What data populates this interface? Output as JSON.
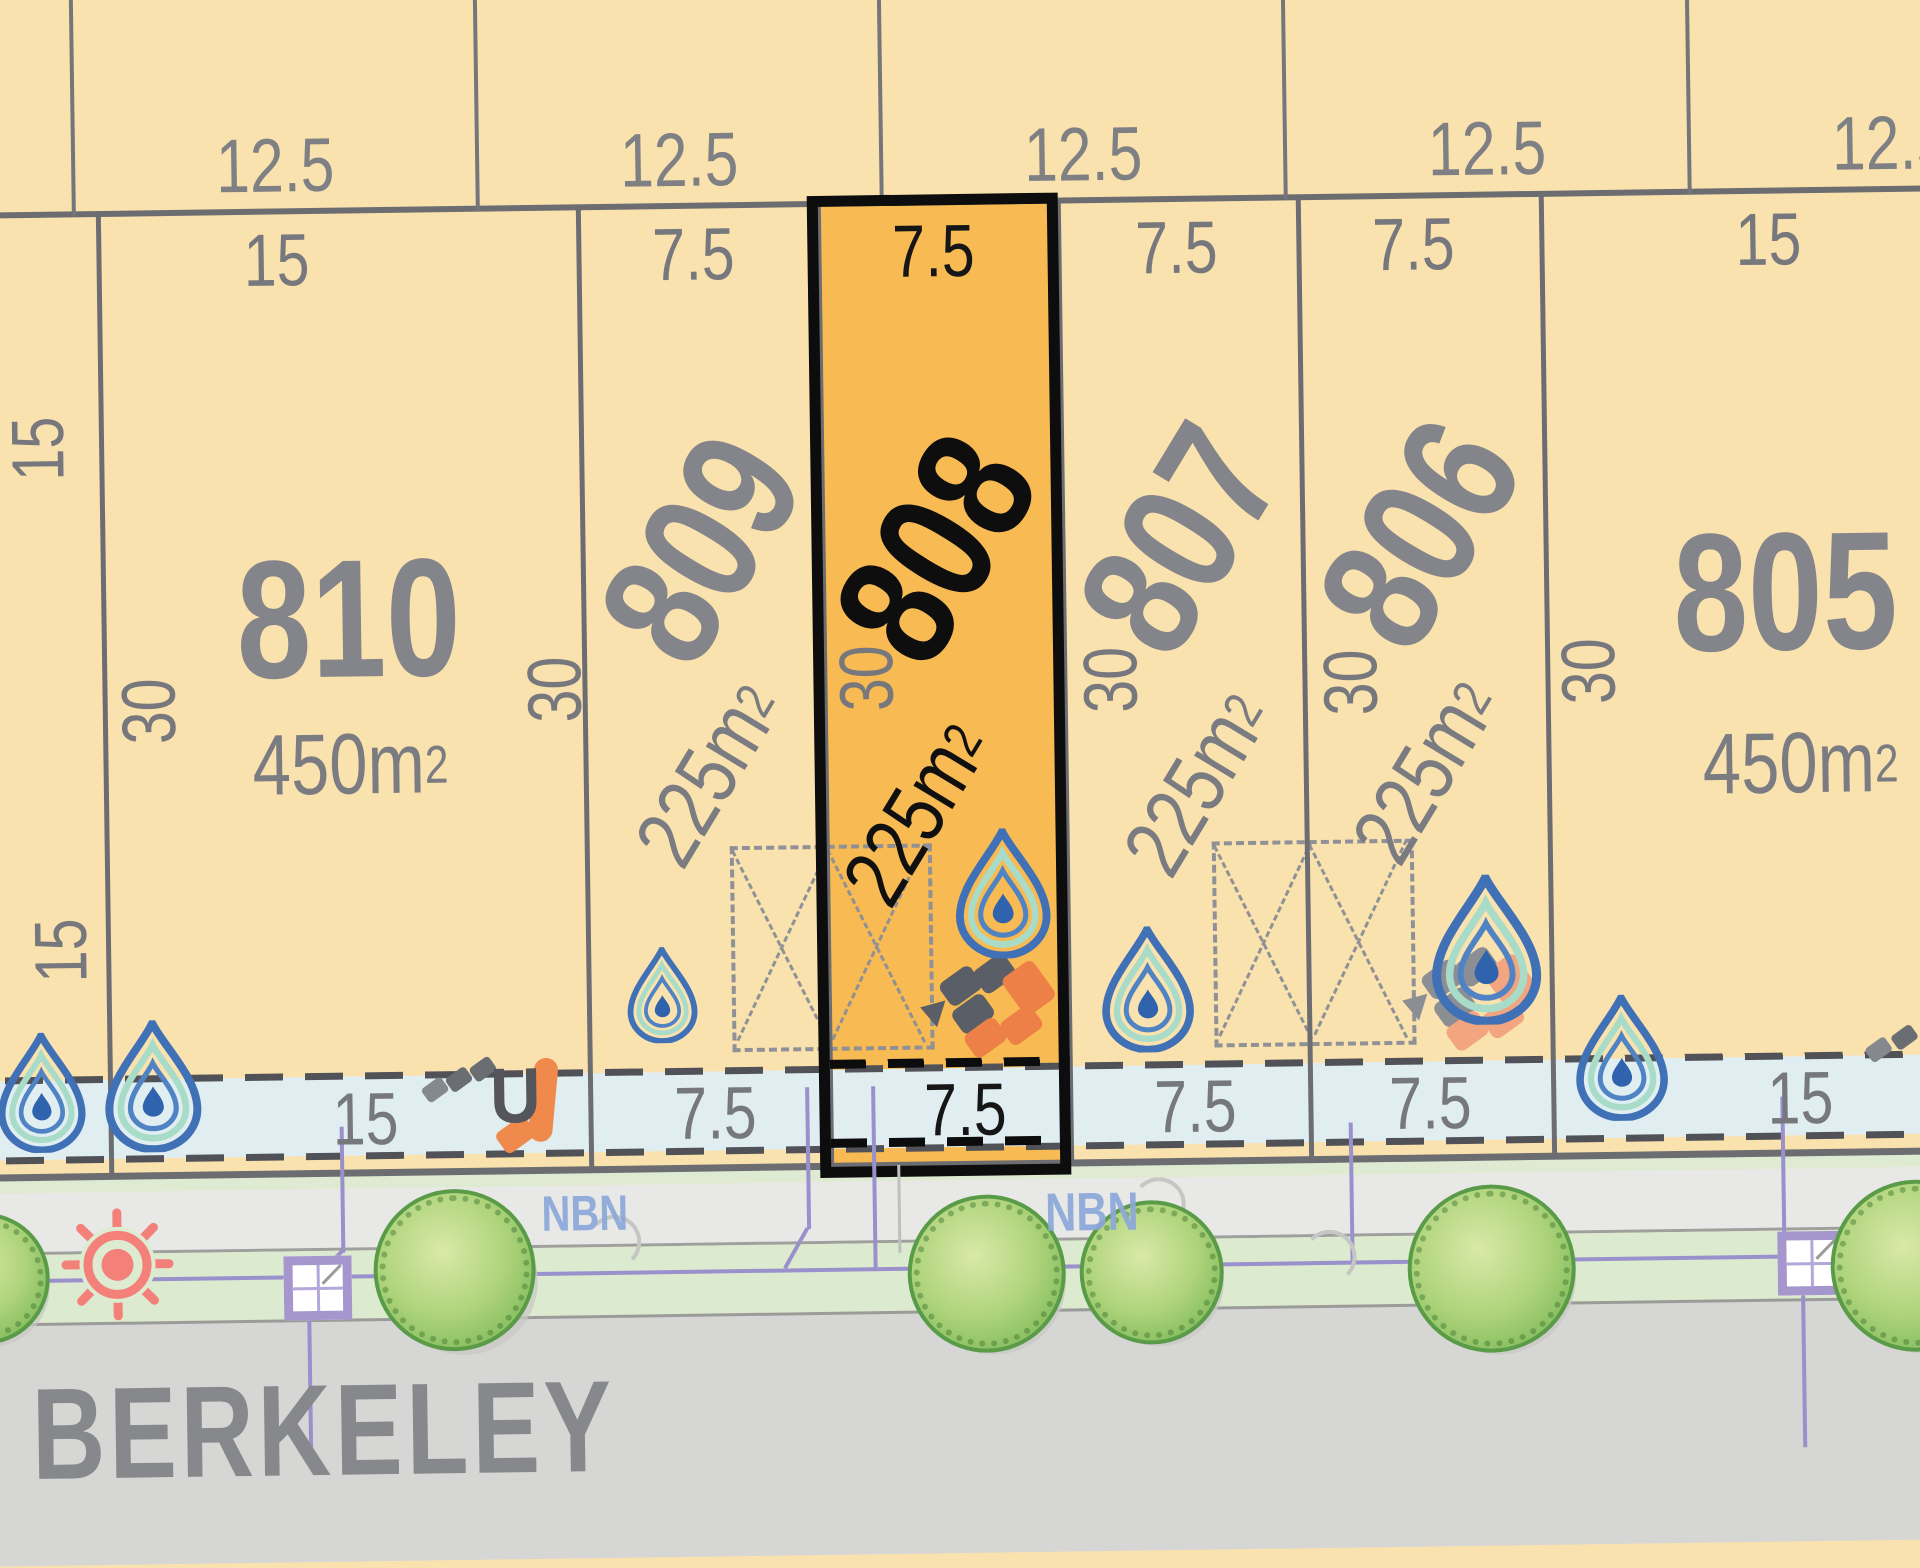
{
  "top_dims": {
    "d1": "12.5",
    "d2": "12.5",
    "d3": "12.5",
    "d4": "12.5",
    "d5": "12.5"
  },
  "front_dims": {
    "f810": "15",
    "f809": "7.5",
    "f808": "7.5",
    "f807": "7.5",
    "f806": "7.5",
    "f805": "15"
  },
  "strip_dims": {
    "s810": "15",
    "s809": "7.5",
    "s808": "7.5",
    "s807": "7.5",
    "s806": "7.5",
    "s805": "15"
  },
  "side_dims": {
    "upper": "15",
    "lower": "15"
  },
  "depth_dims": {
    "k810l": "30",
    "k810r": "30",
    "k808": "30",
    "k807": "30",
    "k806": "30",
    "k805": "30"
  },
  "lots": {
    "l810": {
      "number": "810",
      "area_main": "450m",
      "area_exp": "2"
    },
    "l809": {
      "number": "809",
      "area_main": "225m",
      "area_exp": "2"
    },
    "l808": {
      "number": "808",
      "area_main": "225m",
      "area_exp": "2"
    },
    "l807": {
      "number": "807",
      "area_main": "225m",
      "area_exp": "2"
    },
    "l806": {
      "number": "806",
      "area_main": "225m",
      "area_exp": "2"
    },
    "l805": {
      "number": "805",
      "area_main": "450m",
      "area_exp": "2"
    }
  },
  "street": {
    "name": "BERKELEY"
  },
  "labels": {
    "nbn1": "NBN",
    "nbn2": "NBN",
    "u": "U"
  },
  "colors": {
    "background": "#FAE2AF",
    "highlight": "#F8BA52",
    "highlight_border": "#0D0D0D",
    "boundary": "#6C6D71",
    "easement": "#E0EEF2",
    "road": "#D6D6D4",
    "verge": "#DCEAD0",
    "footpath": "#E8E8E6",
    "tree": "#8CC163",
    "nbn_blue": "#8CA8DA",
    "utility_purple": "#9A90CC",
    "sun_red": "#F4807A",
    "paver_orange": "#EC8046",
    "paver_gray": "#5A5E66",
    "droplet_blue": "#4070B5"
  },
  "icons": [
    "water-droplet-icon",
    "paver-tiles-icon",
    "street-tree-icon",
    "street-light-icon",
    "service-pit-icon",
    "building-envelope-box",
    "u-turn-marker"
  ]
}
